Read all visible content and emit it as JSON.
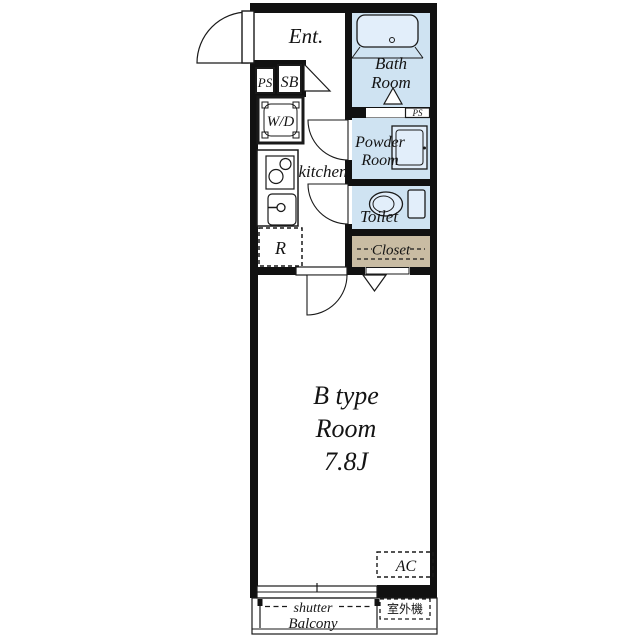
{
  "plan": {
    "labels": {
      "entrance": "Ent.",
      "pipe_space_1": "PS",
      "shoe_box": "SB",
      "washer_dryer": "W/D",
      "kitchen": "kitchen",
      "refrigerator": "R",
      "bath_line1": "Bath",
      "bath_line2": "Room",
      "pipe_space_2": "PS",
      "powder_line1": "Powder",
      "powder_line2": "Room",
      "toilet": "Toilet",
      "closet": "Closet",
      "room_line1": "B type",
      "room_line2": "Room",
      "room_line3": "7.8J",
      "ac": "AC",
      "shutter": "shutter",
      "balcony": "Balcony",
      "outdoor_unit": "室外機"
    },
    "colors": {
      "wall": "#111111",
      "wet_area": "#cfe3f2",
      "fixture": "#e2eefa",
      "closet": "#c9bca3",
      "line": "#1a1a1a"
    }
  }
}
